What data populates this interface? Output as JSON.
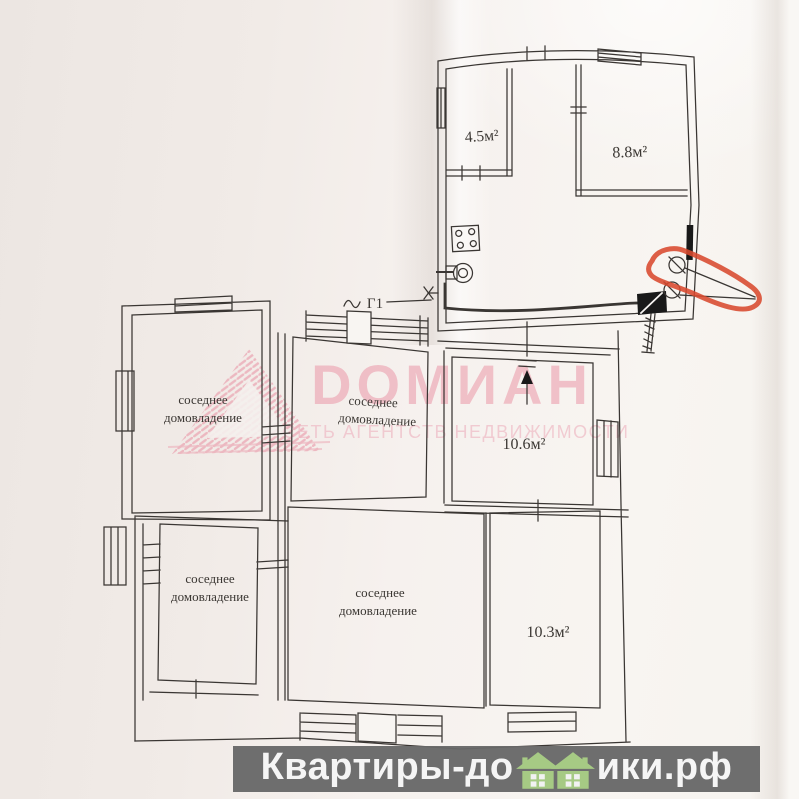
{
  "plan": {
    "top_building": {
      "room_small_area": "4.5м²",
      "room_large_area": "8.8м²"
    },
    "lower_building": {
      "room_106_area": "10.6м²",
      "room_103_area": "10.3м²"
    },
    "neighbor_label": {
      "line1": "соседнее",
      "line2": "домовладение"
    },
    "gas_line_label": "Г1",
    "line_color": "#3a3633",
    "highlight_color": "#d8492d"
  },
  "watermark": {
    "brand": "DОМИАН",
    "tagline": "СЕТЬ АГЕНТСТВ НЕДВИЖИМОСТИ",
    "brand_color": "#ec9fae",
    "tagline_color": "#eeb6c2"
  },
  "footer": {
    "site_prefix": "Квартиры-до",
    "site_suffix": "ики.рф",
    "house_icon_color": "#a6ca84",
    "background_color": "#686868",
    "text_color": "#f5f5f5"
  }
}
